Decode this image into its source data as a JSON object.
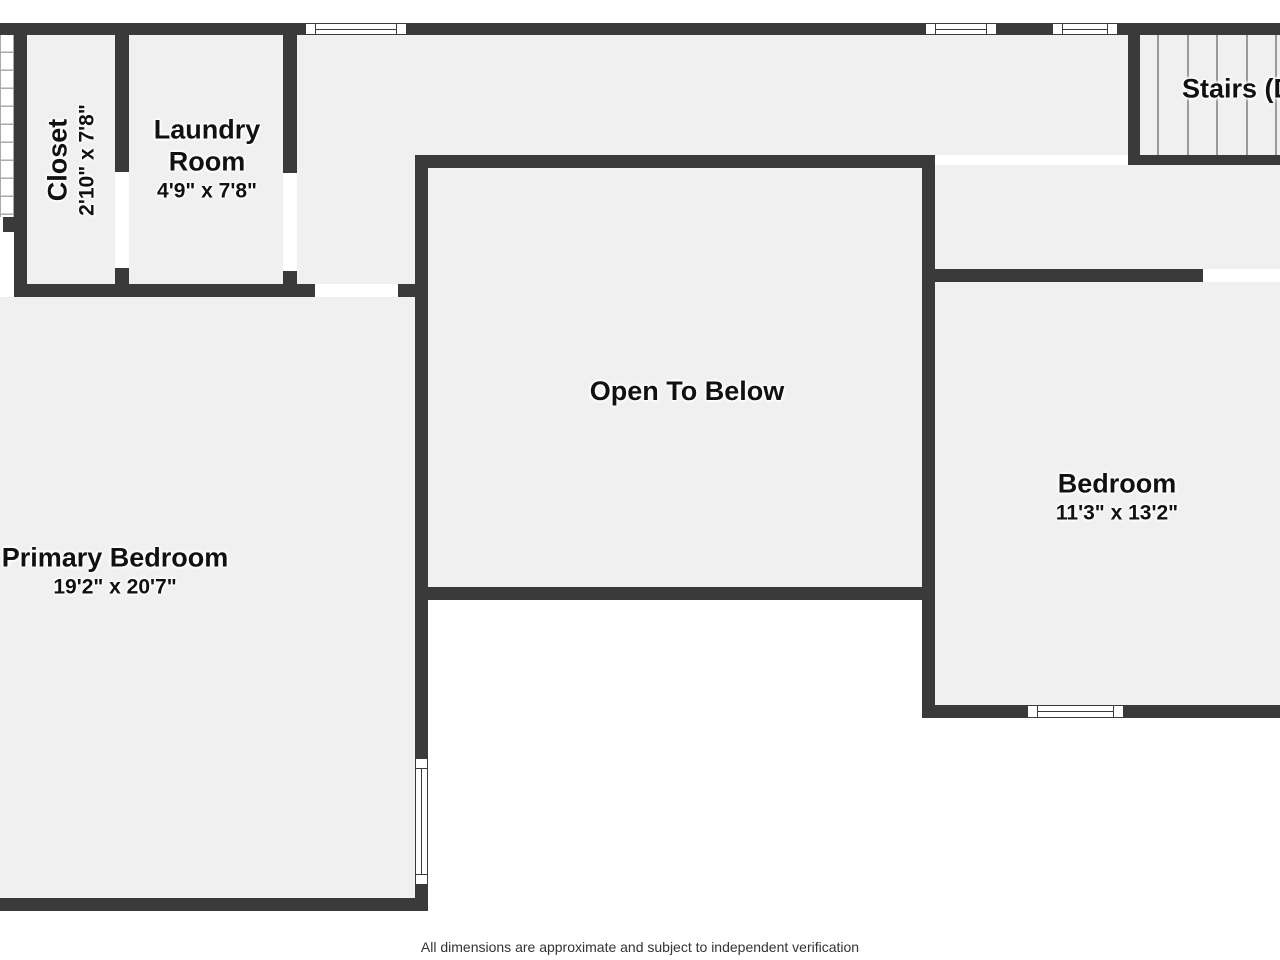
{
  "rooms": {
    "closet": {
      "name": "Closet",
      "dimensions": "2'10\" x 7'8\""
    },
    "laundry": {
      "name": "Laundry Room",
      "dimensions": "4'9\" x 7'8\""
    },
    "open_to_below": {
      "name": "Open To Below"
    },
    "bedroom": {
      "name": "Bedroom",
      "dimensions": "11'3\" x 13'2\""
    },
    "primary_bedroom": {
      "name": "Primary Bedroom",
      "dimensions": "19'2\" x 20'7\""
    },
    "stairs": {
      "name": "Stairs (Down)"
    }
  },
  "footer": {
    "disclaimer": "All dimensions are approximate and subject to independent verification"
  },
  "colors": {
    "wall": "#3a3a3a",
    "floor": "#f0f0f1",
    "background": "#ffffff",
    "label_text": "#111111",
    "tread_line": "#999999",
    "footer_text": "#333333"
  }
}
